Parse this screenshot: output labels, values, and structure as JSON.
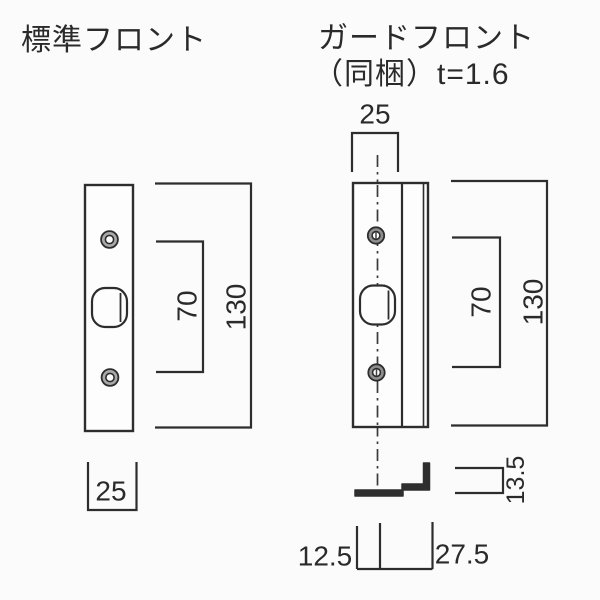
{
  "page": {
    "background": "#fbfbfb",
    "line_color": "#2d2d2d"
  },
  "left_drawing": {
    "title": "標準フロント",
    "labels": {
      "total_height": "130",
      "hole_spacing": "70",
      "width": "25"
    }
  },
  "right_drawing": {
    "title_line1": "ガードフロント",
    "title_line2": "（同梱）t=1.6",
    "labels": {
      "width_top": "25",
      "hole_spacing": "70",
      "total_height": "130",
      "flange_height": "13.5",
      "offset_left": "12.5",
      "offset_right": "27.5"
    }
  }
}
